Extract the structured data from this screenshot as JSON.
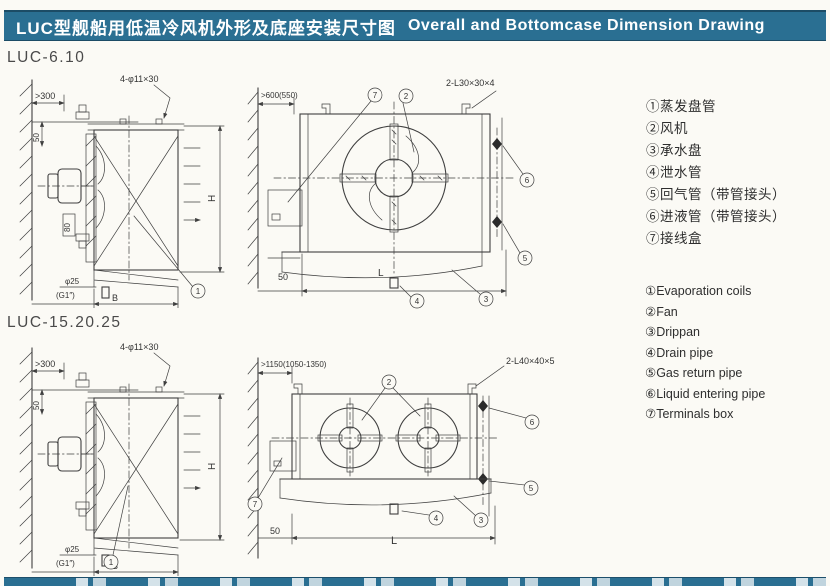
{
  "header": {
    "title_cn": "LUC型舰船用低温冷风机外形及底座安装尺寸图",
    "title_en": "Overall and Bottomcase Dimension Drawing"
  },
  "sections": {
    "s1_label": "LUC-6.10",
    "s2_label": "LUC-15.20.25"
  },
  "digits": {
    "d1": "1",
    "d2": "2",
    "d3": "3",
    "d4": "4",
    "d5": "5",
    "d6": "6",
    "d7": "7"
  },
  "fig1": {
    "wall_dim": ">300",
    "dim_50": "50",
    "holes": "4-φ11×30",
    "dim_H": "H",
    "dim_80": "80",
    "drain_dia": "φ25",
    "drain_thread": "(G1″)",
    "dim_B": "B"
  },
  "fig2": {
    "wall_dim": ">600(550)",
    "angle_steel": "2-L30×30×4",
    "dim_50": "50",
    "dim_L": "L"
  },
  "fig3": {
    "wall_dim": ">300",
    "dim_50": "50",
    "holes": "4-φ11×30",
    "dim_H": "H",
    "drain_dia": "φ25",
    "drain_thread": "(G1″)",
    "dim_B": "B"
  },
  "fig4": {
    "wall_dim": ">1150(1050-1350)",
    "angle_steel": "2-L40×40×5",
    "dim_50": "50",
    "dim_L": "L"
  },
  "legend_cn": {
    "items": [
      "①蒸发盘管",
      "②风机",
      "③承水盘",
      "④泄水管",
      "⑤回气管（带管接头）",
      "⑥进液管（带管接头）",
      "⑦接线盒"
    ]
  },
  "legend_en": {
    "items": [
      "①Evaporation coils",
      "②Fan",
      "③Drippan",
      "④Drain pipe",
      "⑤Gas return pipe",
      "⑥Liquid entering pipe",
      "⑦Terminals box"
    ]
  }
}
